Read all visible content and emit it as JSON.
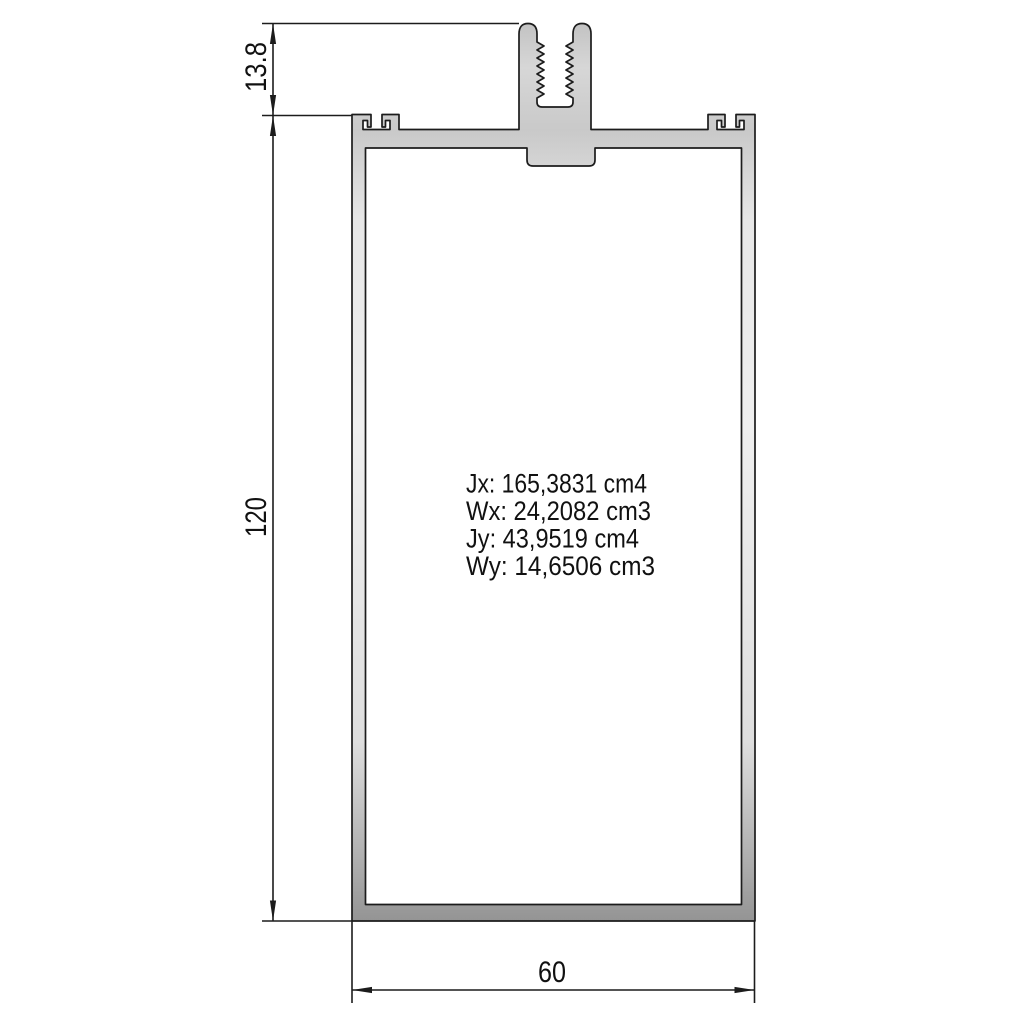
{
  "dimensions": {
    "top_height": "13.8",
    "total_height": "120",
    "width": "60"
  },
  "section_properties": {
    "jx": "Jx: 165,3831 cm4",
    "wx": "Wx: 24,2082 cm3",
    "jy": "Jy: 43,9519 cm4",
    "wy": "Wy: 14,6506 cm3"
  },
  "colors": {
    "outline": "#1c1c1c",
    "dimension_lines": "#1c1c1c",
    "aluminium_light": "#efefef",
    "aluminium_mid": "#cccccc",
    "aluminium_dark": "#979797",
    "background": "#ffffff"
  }
}
